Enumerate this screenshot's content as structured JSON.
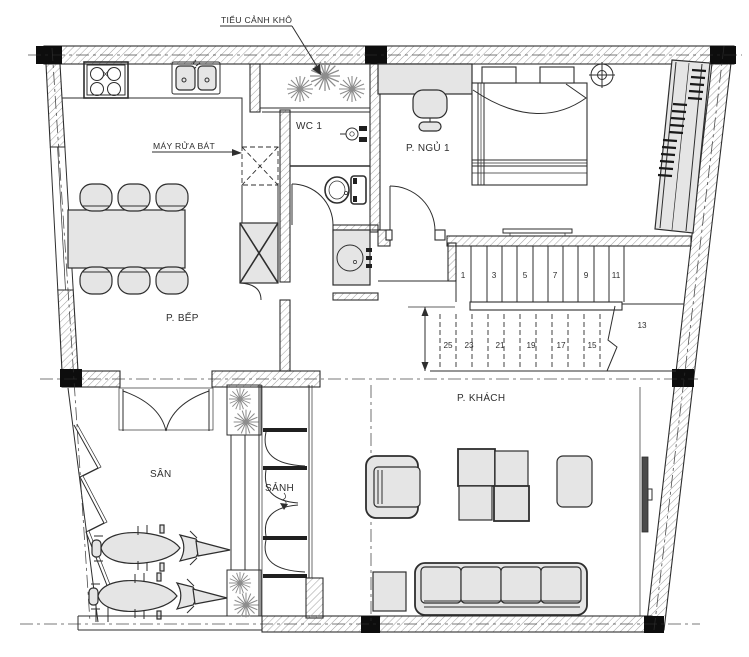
{
  "annotations": {
    "dry_garden_label": "TIỂU CẢNH KHÔ",
    "dishwasher_label": "MÁY RỬA BÁT"
  },
  "rooms": {
    "wc": "WC 1",
    "bedroom": "P. NGỦ 1",
    "kitchen": "P. BẾP",
    "living_room": "P. KHÁCH",
    "yard": "SÂN",
    "hall": "SẢNH"
  },
  "stairs": {
    "upper_steps": [
      "1",
      "3",
      "5",
      "7",
      "9",
      "11"
    ],
    "lower_steps": [
      "25",
      "23",
      "21",
      "19",
      "17",
      "15"
    ],
    "landing_step": "13"
  },
  "colors": {
    "line": "#2e2e2e",
    "wall_hatch": "#a2a2a2",
    "furniture_fill": "#e5e5e5",
    "column_fill": "#0d0d0d",
    "plant_stroke": "#8d8d8d",
    "background": "#ffffff"
  }
}
